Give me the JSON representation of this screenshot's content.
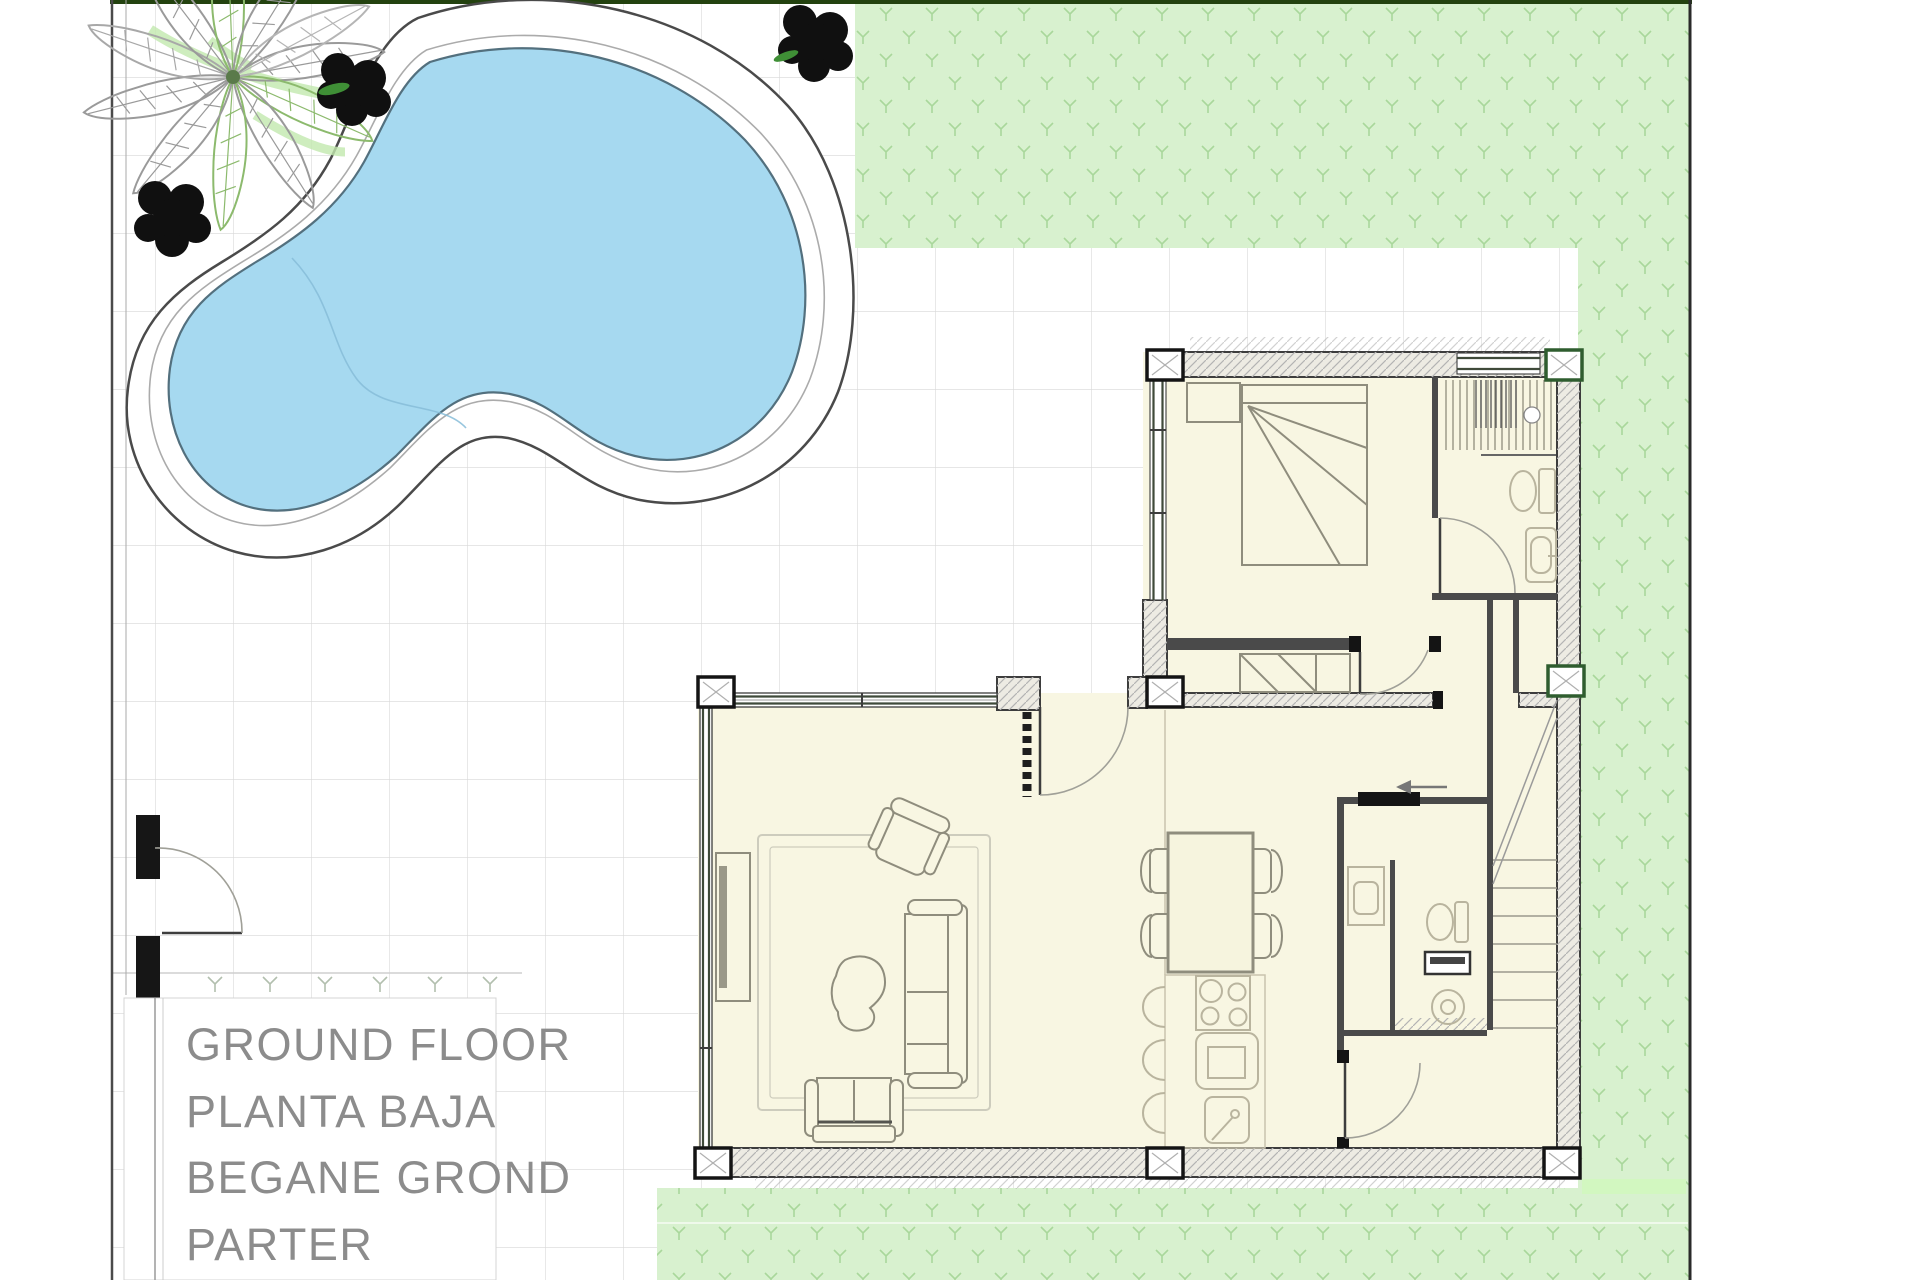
{
  "plan": {
    "type": "architectural-floor-plan",
    "floor_labels": [
      "GROUND FLOOR",
      "PLANTA BAJA",
      "BEGANE GROND",
      "PARTER"
    ],
    "rooms": [
      "bedroom",
      "bathroom",
      "hallway",
      "living-room",
      "dining-area",
      "kitchen",
      "utility-room",
      "staircase",
      "entry-hall"
    ],
    "outdoor": [
      "swimming-pool",
      "pool-deck",
      "palm-tree",
      "bushes",
      "lawn",
      "tiled-patio",
      "entrance-gate"
    ],
    "colors": {
      "pool_water": "#a6d9f0",
      "pool_outline": "#53707e",
      "deck_outline": "#4a4a4a",
      "grass": "#d8f1cf",
      "grass_bright": "#d2f7c0",
      "grass_mark": "#a9d79b",
      "grass_border": "#23420f",
      "floor": "#f8f6e2",
      "wall": "#3d3d3d",
      "furniture": "#8f8d7d",
      "fixture": "#b9b49e",
      "label_text": "#8c8c8c",
      "plant_green": "#8cba6d",
      "plant_gray": "#9a9a9a",
      "bush": "#101010",
      "column_green": "#2f5d2f",
      "tile_line": "#d8d8d8"
    }
  }
}
